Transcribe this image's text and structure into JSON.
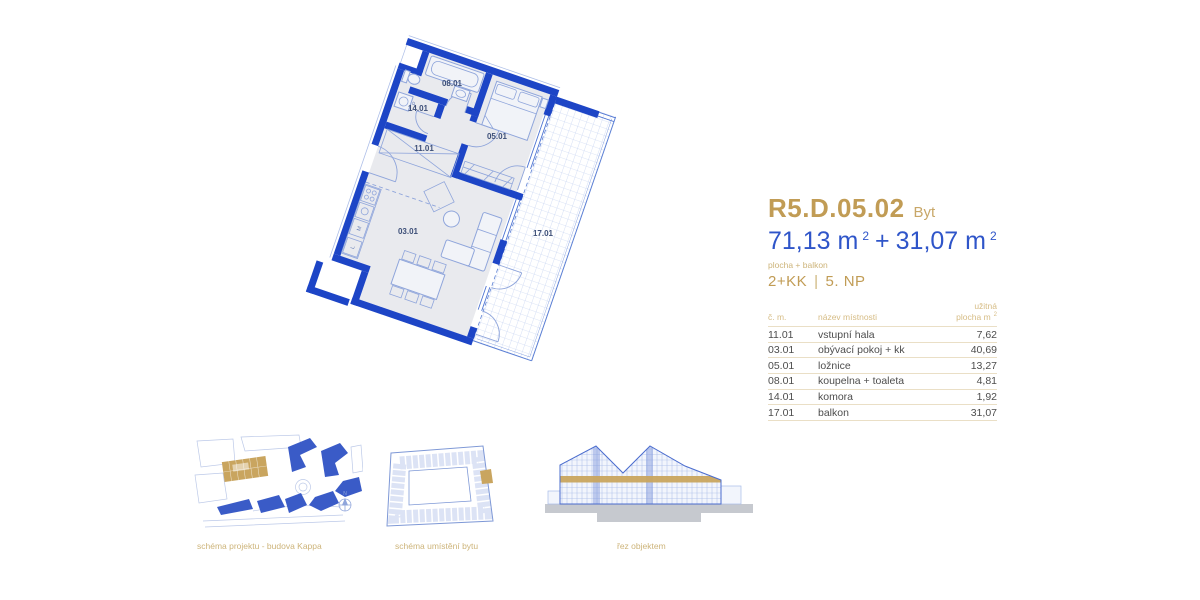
{
  "unit": {
    "id": "R5.D.05.02",
    "type": "Byt",
    "disposition": "2+KK",
    "separator": "|",
    "floor": "5. NP"
  },
  "area": {
    "main": "71,13 m",
    "sup1": "2",
    "plus": "+",
    "balcony": "31,07 m",
    "sup2": "2",
    "note": "plocha + balkon"
  },
  "table": {
    "headers": {
      "no": "č. m.",
      "name": "název místnosti",
      "area1": "užitná",
      "area2": "plocha m",
      "sup": "2"
    },
    "rows": [
      {
        "no": "11.01",
        "name": "vstupní hala",
        "area": "7,62"
      },
      {
        "no": "03.01",
        "name": "obývací pokoj + kk",
        "area": "40,69"
      },
      {
        "no": "05.01",
        "name": "ložnice",
        "area": "13,27"
      },
      {
        "no": "08.01",
        "name": "koupelna + toaleta",
        "area": "4,81"
      },
      {
        "no": "14.01",
        "name": "komora",
        "area": "1,92"
      },
      {
        "no": "17.01",
        "name": "balkon",
        "area": "31,07"
      }
    ]
  },
  "plan": {
    "labels": [
      "08.01",
      "14.01",
      "11.01",
      "05.01",
      "03.01",
      "17.01"
    ],
    "appliances": {
      "m": "M",
      "l": "L",
      "p": "P"
    }
  },
  "diagrams": {
    "site": {
      "caption": "schéma projektu - budova Kappa",
      "compass": "N"
    },
    "location": {
      "caption": "schéma umístění bytu"
    },
    "section": {
      "caption": "řez objektem"
    }
  },
  "colors": {
    "accent_gold": "#C19C55",
    "gold_light": "#CDB47A",
    "area_blue": "#2F55C9",
    "wall_blue": "#1D45C6",
    "plan_fill": "#E9EAEE",
    "plan_line": "#8FA5DB",
    "grid_blue": "#B9C9EE",
    "label_blue": "#3D4F78",
    "text_gray": "#4D4D4D"
  }
}
